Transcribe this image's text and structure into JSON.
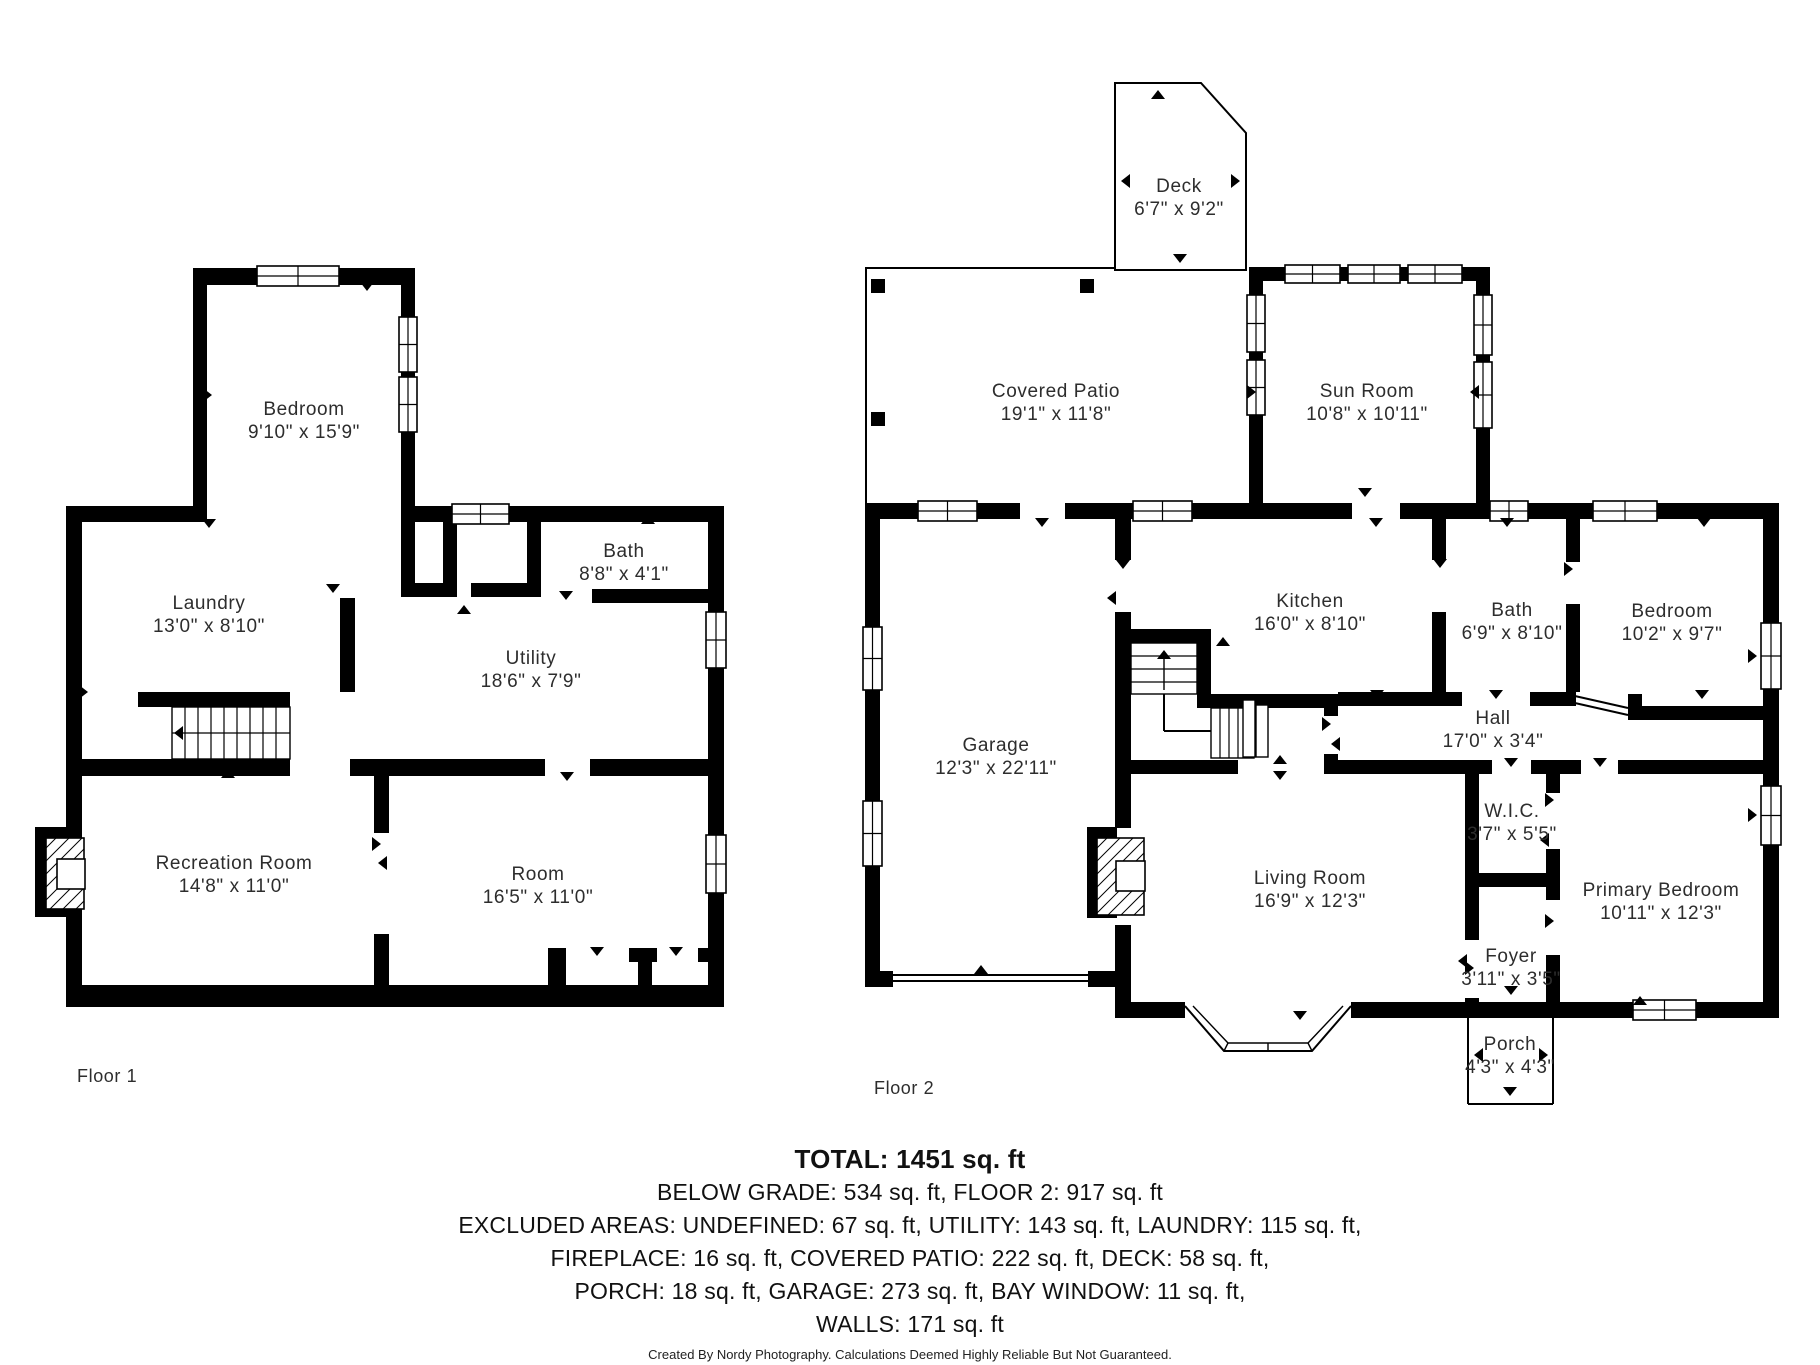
{
  "title": "Residential Floor Plan",
  "colors": {
    "walls": "#000000",
    "background": "#ffffff",
    "label_text": "#2d2d2d",
    "summary_text": "#111111"
  },
  "floors": [
    {
      "label": "Floor 1",
      "rooms": [
        {
          "name": "Bedroom",
          "dims": "9'10\" x 15'9\""
        },
        {
          "name": "Laundry",
          "dims": "13'0\" x 8'10\""
        },
        {
          "name": "Bath",
          "dims": "8'8\" x 4'1\""
        },
        {
          "name": "Utility",
          "dims": "18'6\" x 7'9\""
        },
        {
          "name": "Recreation Room",
          "dims": "14'8\" x 11'0\""
        },
        {
          "name": "Room",
          "dims": "16'5\" x 11'0\""
        }
      ]
    },
    {
      "label": "Floor 2",
      "rooms": [
        {
          "name": "Deck",
          "dims": "6'7\" x 9'2\""
        },
        {
          "name": "Covered Patio",
          "dims": "19'1\" x 11'8\""
        },
        {
          "name": "Sun Room",
          "dims": "10'8\" x 10'11\""
        },
        {
          "name": "Kitchen",
          "dims": "16'0\" x 8'10\""
        },
        {
          "name": "Bath",
          "dims": "6'9\" x 8'10\""
        },
        {
          "name": "Bedroom",
          "dims": "10'2\" x 9'7\""
        },
        {
          "name": "Hall",
          "dims": "17'0\" x 3'4\""
        },
        {
          "name": "Garage",
          "dims": "12'3\" x 22'11\""
        },
        {
          "name": "Living Room",
          "dims": "16'9\" x 12'3\""
        },
        {
          "name": "W.I.C.",
          "dims": "3'7\" x 5'5\""
        },
        {
          "name": "Primary Bedroom",
          "dims": "10'11\" x 12'3\""
        },
        {
          "name": "Foyer",
          "dims": "3'11\" x 3'5\""
        },
        {
          "name": "Porch",
          "dims": "4'3\" x 4'3\""
        }
      ]
    }
  ],
  "summary": {
    "total": "TOTAL: 1451 sq. ft",
    "lines": [
      "BELOW GRADE: 534 sq. ft, FLOOR 2: 917 sq. ft",
      "EXCLUDED AREAS: UNDEFINED: 67 sq. ft, UTILITY: 143 sq. ft, LAUNDRY: 115 sq. ft,",
      "FIREPLACE: 16 sq. ft, COVERED PATIO: 222 sq. ft, DECK: 58 sq. ft,",
      "PORCH: 18 sq. ft, GARAGE: 273 sq. ft, BAY WINDOW: 11 sq. ft,",
      "WALLS: 171 sq. ft"
    ],
    "credit": "Created By Nordy Photography. Calculations Deemed Highly Reliable But Not Guaranteed."
  }
}
